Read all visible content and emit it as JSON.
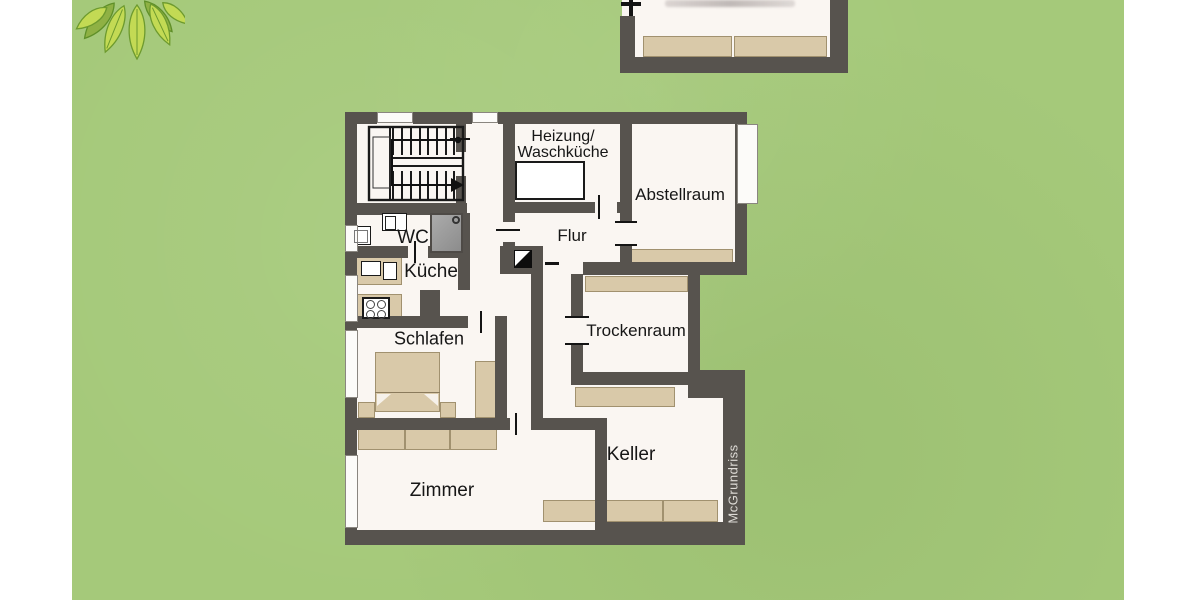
{
  "floor_plan": {
    "brand_watermark": "McGrundriss",
    "rooms": {
      "heizung_waschkueche": {
        "label_line1": "Heizung/",
        "label_line2": "Waschküche"
      },
      "abstellraum": {
        "label": "Abstellraum"
      },
      "flur": {
        "label": "Flur"
      },
      "wc": {
        "label": "WC"
      },
      "kueche": {
        "label": "Küche"
      },
      "schlafen": {
        "label": "Schlafen"
      },
      "trockenraum": {
        "label": "Trockenraum"
      },
      "zimmer": {
        "label": "Zimmer"
      },
      "keller": {
        "label": "Keller"
      }
    }
  },
  "colors": {
    "background_green": "#a5c97a",
    "letterbox_white": "#ffffff",
    "wall": "#57534e",
    "room_fill": "#faf6f2",
    "furniture_tan": "#d9c9a9",
    "furniture_border": "#a1916f",
    "label_text": "#161616",
    "watermark_text": "#dedbd6",
    "leaf_green_light": "#c3da54",
    "leaf_green_dark": "#8fb144",
    "shower_gray": "#9a9a9a"
  }
}
